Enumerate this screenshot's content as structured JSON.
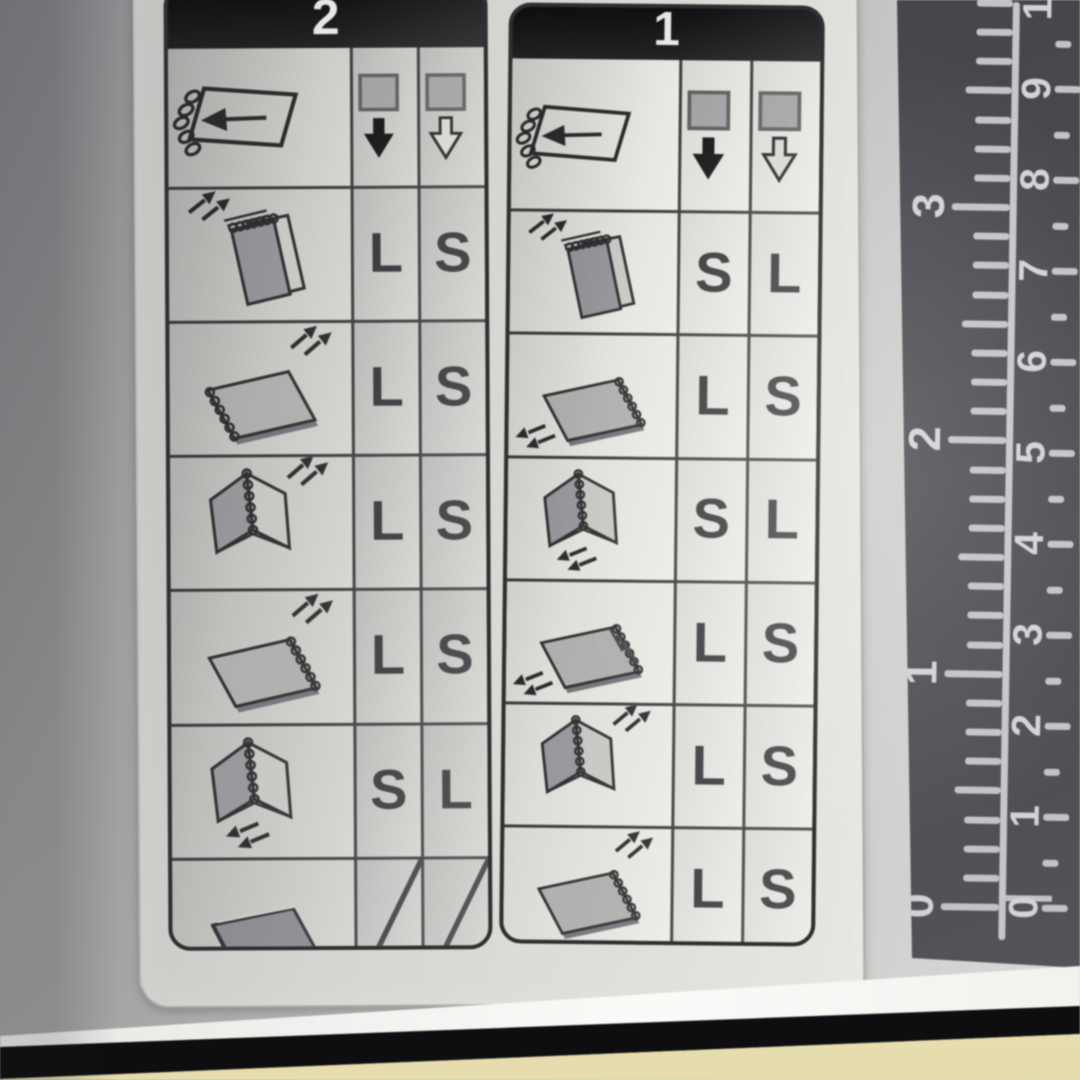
{
  "label": {
    "tables": [
      {
        "number": "2",
        "header_icons": [
          "document-feed-direction-icon",
          "sheet-face-down-arrow-icon",
          "sheet-face-up-arrow-icon"
        ],
        "rows": [
          {
            "icon": "booklet-standing-binding-top-icon",
            "cells": [
              "L",
              "S"
            ]
          },
          {
            "icon": "booklet-flat-binding-left-icon",
            "cells": [
              "L",
              "S"
            ]
          },
          {
            "icon": "booklet-standing-open-icon",
            "cells": [
              "L",
              "S"
            ]
          },
          {
            "icon": "booklet-flat-binding-right-icon",
            "cells": [
              "L",
              "S"
            ]
          },
          {
            "icon": "booklet-standing-open-feed-icon",
            "cells": [
              "S",
              "L"
            ]
          },
          {
            "icon": "booklet-flat-closed-icon",
            "cells": [
              null,
              null
            ]
          }
        ]
      },
      {
        "number": "1",
        "header_icons": [
          "document-feed-direction-icon",
          "sheet-face-down-arrow-icon",
          "sheet-face-up-arrow-icon"
        ],
        "rows": [
          {
            "icon": "booklet-standing-binding-top-icon",
            "cells": [
              "S",
              "L"
            ]
          },
          {
            "icon": "booklet-flat-binding-right-arrow-low-icon",
            "cells": [
              "L",
              "S"
            ]
          },
          {
            "icon": "booklet-standing-open-feed-icon",
            "cells": [
              "S",
              "L"
            ]
          },
          {
            "icon": "booklet-flat-binding-right-hatch-icon",
            "cells": [
              "L",
              "S"
            ]
          },
          {
            "icon": "booklet-standing-open-icon",
            "cells": [
              "L",
              "S"
            ]
          },
          {
            "icon": "booklet-flat-binding-right-icon",
            "cells": [
              "L",
              "S"
            ]
          }
        ]
      }
    ]
  },
  "ruler": {
    "inch_labels": [
      "0",
      "1",
      "2",
      "3"
    ],
    "cm_labels": [
      "0",
      "1",
      "2",
      "3",
      "4",
      "5",
      "6",
      "7",
      "8",
      "9",
      "10"
    ]
  },
  "colors": {
    "header_bar": "#1a1a1c",
    "table_line": "#3a3a3c",
    "letter": "#343437",
    "ruler_bg": "#47494d",
    "ruler_mark": "#c9cacd",
    "machine_body": "#eadfb4",
    "gap_shadow": "#0d0d0f"
  }
}
